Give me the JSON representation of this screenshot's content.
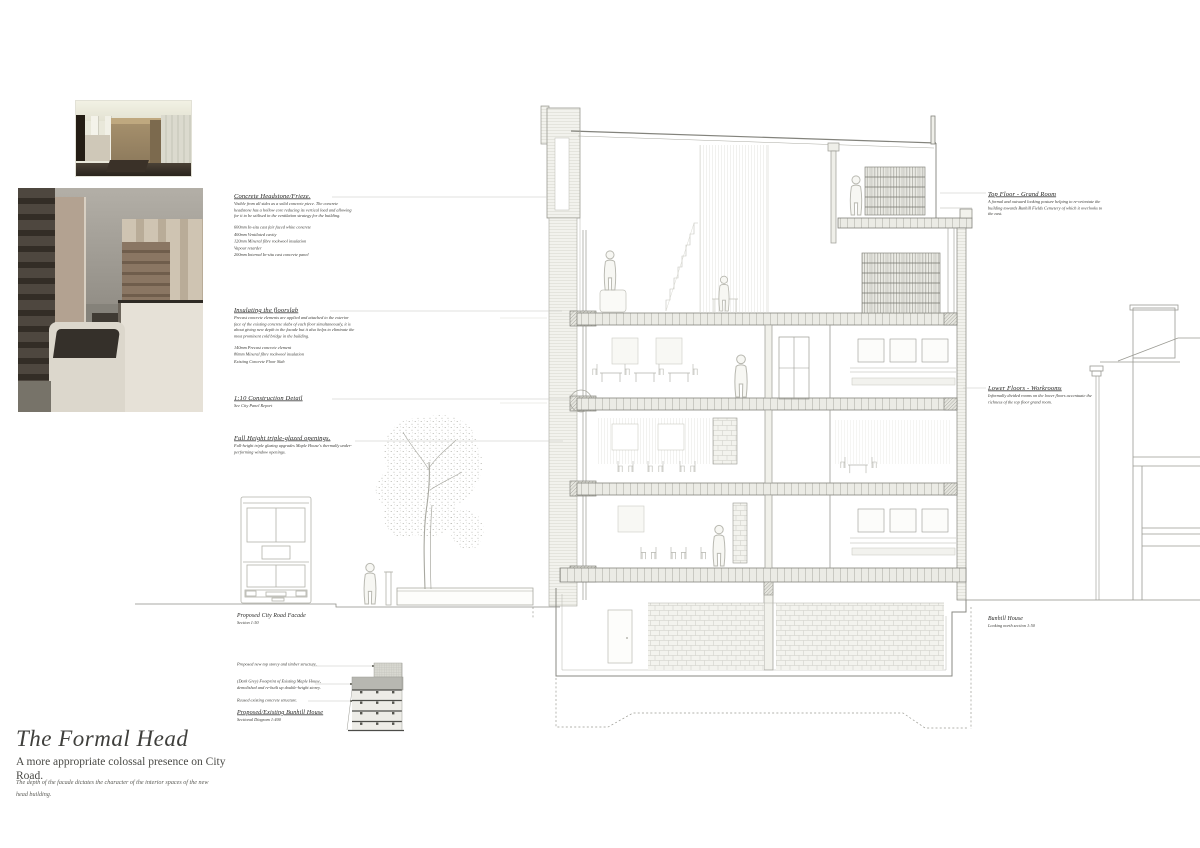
{
  "title_block": {
    "title": "The Formal Head",
    "subtitle": "A more appropriate colossal presence on City Road.",
    "caption": "The depth of the facade dictates the character of the interior spaces of the new head building."
  },
  "left_annotations": {
    "headstone": {
      "heading": "Concrete Headstone/Frieze.",
      "body": "Visible from all sides as a solid concrete piece. The concrete headstone has a hollow core reducing its vertical load and allowing for it to be utilised in the ventilation strategy for the building.",
      "spec": "600mm In-situ cast fair faced white concrete\n400mm Ventilated cavity\n120mm Mineral fibre rockwool insulation\nVapour retarder\n200mm Internal In-situ cast concrete panel"
    },
    "floorslab": {
      "heading": "Insulating the floorslab",
      "body": "Precast concrete elements are applied and attached to the exterior face of the existing concrete slabs of each floor simultaneously, it is about giving new depth to the facade but it also helps to eliminate the most prominent cold bridge in the building.",
      "spec": "140mm Precast concrete element\n80mm Mineral fibre rockwool insulation\nExisting Concrete Floor Slab"
    },
    "detail": {
      "heading": "1:10 Construction Detail",
      "body": "See City Panel Report"
    },
    "glazing": {
      "heading": "Full Height triple-glazed openings.",
      "body": "Full-height triple glazing upgrades Maple House's thermally under-performing window openings."
    }
  },
  "right_annotations": {
    "grand_room": {
      "heading": "Top Floor - Grand Room",
      "body": "A formal and outward looking posture helping to re-orientate the building towards Bunhill Fields Cemetery of which it overlooks to the east."
    },
    "workrooms": {
      "heading": "Lower Floors - Workrooms",
      "body": "Informally divided rooms on the lower floors accentuate the richness of the top floor grand room."
    },
    "bunhill": {
      "heading": "Bunhill House",
      "body": "Looking north section 1:50"
    }
  },
  "captions": {
    "facade": {
      "heading": "Proposed City Road Facade",
      "sub": "Section 1:50"
    },
    "diagram": {
      "heading": "Proposed/Existing Bunhill House",
      "sub": "Sectional Diagram 1:400",
      "callout_top": "Proposed new top storey and timber structure.",
      "callout_mid": "(Dark Grey) Footprint of Existing Maple House, demolished and re-built up double-height storey.",
      "callout_bottom": "Reused existing concrete structure."
    }
  },
  "colors": {
    "paper": "#ffffff",
    "drawing_line": "#8c8c86",
    "light_line": "#b9b9b2",
    "hatch_line": "#b3b3ab",
    "text": "#2a2a28",
    "diagram_existing_gray": "#b7b7b1",
    "diagram_new_gray": "#d9d9d2",
    "diagram_floor": "#edece7",
    "photo_sepia": "#b3a291"
  }
}
